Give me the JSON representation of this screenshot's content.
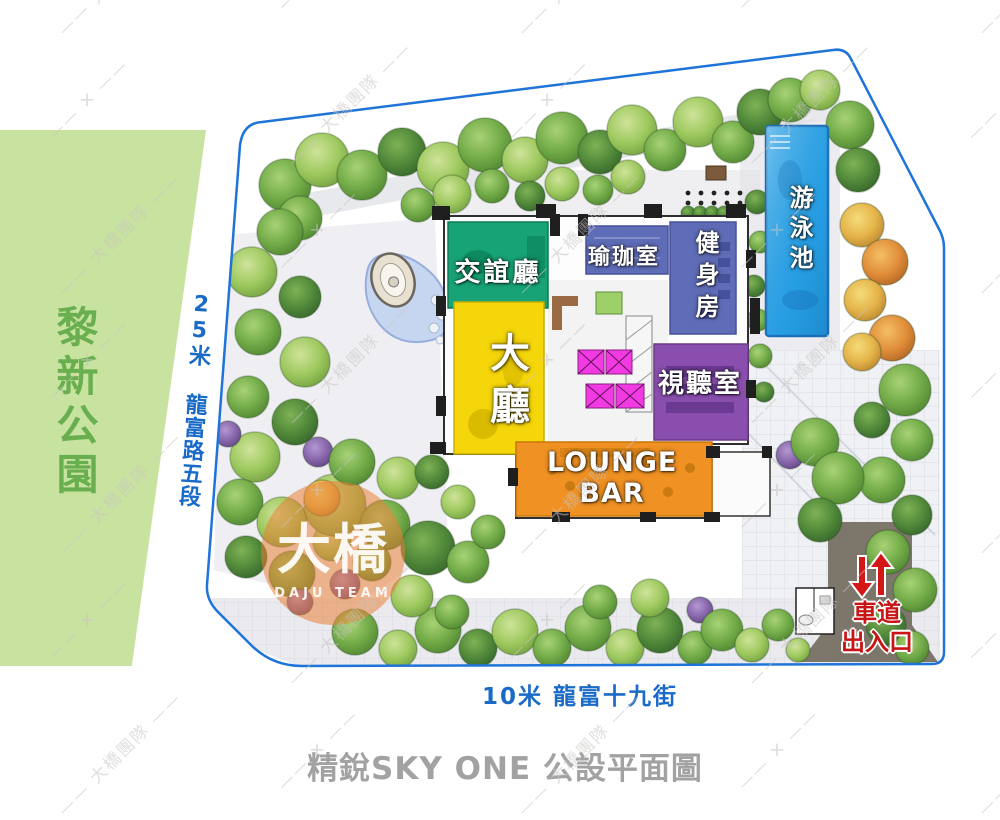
{
  "caption": "精銳SKY ONE 公設平面圖",
  "park": {
    "label": "黎新公園"
  },
  "roads": {
    "west_label": "25米 龍富路五段",
    "south_label": "10米 龍富十九街"
  },
  "rooms": [
    {
      "name": "social-lounge",
      "label": "交誼廳",
      "color": "#18a377"
    },
    {
      "name": "yoga-room",
      "label": "瑜珈室",
      "color": "#5f6db8"
    },
    {
      "name": "gym",
      "label": "健身房",
      "color": "#5f6db8"
    },
    {
      "name": "lobby",
      "label": "大廳",
      "color": "#f5d60a"
    },
    {
      "name": "av-room",
      "label": "視聽室",
      "color": "#8a4fae"
    },
    {
      "name": "lounge-bar",
      "label": "LOUNGE BAR",
      "color": "#f09123"
    },
    {
      "name": "swimming-pool",
      "label": "游泳池",
      "color": "#2ba2e6"
    }
  ],
  "driveway": {
    "label_lines": [
      "車道",
      "出入口"
    ]
  },
  "watermark": {
    "tile_text": "大橋團隊",
    "logo_text": "大橋",
    "logo_subtext": "DAJU TEAM"
  },
  "colors": {
    "accent_border": "#1e74d8",
    "road_text": "#1a6ac8",
    "park_fill": "#c8e3a0",
    "park_text": "#69af50",
    "title_text": "#a2a2a2",
    "driveway_text": "#c81414",
    "watermark": "#c8c5c2",
    "driveway_fill": "#7d766b"
  }
}
